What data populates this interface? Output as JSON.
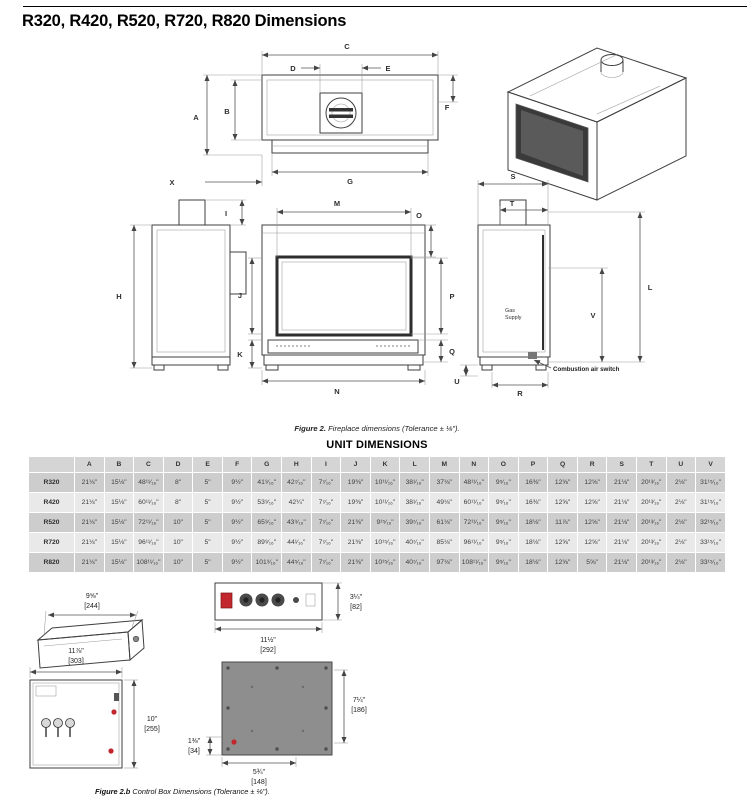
{
  "page": {
    "title": "R320, R420, R520, R720, R820 Dimensions"
  },
  "figure2": {
    "labels": {
      "A": "A",
      "B": "B",
      "C": "C",
      "D": "D",
      "E": "E",
      "F": "F",
      "G": "G",
      "H": "H",
      "I": "I",
      "J": "J",
      "K": "K",
      "L": "L",
      "M": "M",
      "N": "N",
      "O": "O",
      "P": "P",
      "Q": "Q",
      "R": "R",
      "S": "S",
      "T": "T",
      "U": "U",
      "V": "V",
      "X": "X"
    },
    "gas_supply_line1": "Gas",
    "gas_supply_line2": "Supply",
    "combustion_air_switch": "Combustion air switch",
    "caption_label": "Figure 2.",
    "caption_text": "  Fireplace dimensions (Tolerance ± ⅛\")."
  },
  "table": {
    "title": "UNIT DIMENSIONS",
    "columns": [
      "A",
      "B",
      "C",
      "D",
      "E",
      "F",
      "G",
      "H",
      "I",
      "J",
      "K",
      "L",
      "M",
      "N",
      "O",
      "P",
      "Q",
      "R",
      "S",
      "T",
      "U",
      "V"
    ],
    "rows": [
      {
        "model": "R320",
        "values": [
          "21⅛\"",
          "15⅛\"",
          "48¹¹⁄₁₆\"",
          "8\"",
          "5\"",
          "9½\"",
          "41⁹⁄₁₆\"",
          "42⁷⁄₁₆\"",
          "7⁷⁄₁₆\"",
          "19⅜\"",
          "10¹¹⁄₁₆\"",
          "38¹⁄₁₆\"",
          "37⅛\"",
          "48¹¹⁄₁₆\"",
          "9⁵⁄₁₆\"",
          "16⅜\"",
          "12⅝\"",
          "12⅝\"",
          "21⅛\"",
          "20¹³⁄₁₆\"",
          "2⅛\"",
          "31¹⁵⁄₁₆\""
        ]
      },
      {
        "model": "R420",
        "values": [
          "21⅛\"",
          "15⅛\"",
          "60¹¹⁄₁₆\"",
          "8\"",
          "5\"",
          "9½\"",
          "53⁹⁄₁₆\"",
          "42¼\"",
          "7⁷⁄₁₆\"",
          "19⅜\"",
          "10¹¹⁄₁₆\"",
          "38¹⁄₁₆\"",
          "49⅛\"",
          "60¹¹⁄₁₆\"",
          "9⁵⁄₁₆\"",
          "16⅜\"",
          "12⅝\"",
          "12⅝\"",
          "21⅛\"",
          "20¹³⁄₁₆\"",
          "2⅛\"",
          "31¹⁵⁄₁₆\""
        ]
      },
      {
        "model": "R520",
        "values": [
          "21⅛\"",
          "15⅛\"",
          "72¹¹⁄₁₆\"",
          "10\"",
          "5\"",
          "9½\"",
          "65⁹⁄₁₆\"",
          "43⁹⁄₁₆\"",
          "7⁷⁄₁₆\"",
          "21⅜\"",
          "9¹⁵⁄₁₆\"",
          "39⁷⁄₁₆\"",
          "61⅛\"",
          "72¹¹⁄₁₆\"",
          "9⁵⁄₁₆\"",
          "18⅛\"",
          "11⅞\"",
          "12⅝\"",
          "21⅛\"",
          "20¹³⁄₁₆\"",
          "2⅛\"",
          "32¹⁵⁄₁₆\""
        ]
      },
      {
        "model": "R720",
        "values": [
          "21⅛\"",
          "15⅛\"",
          "96¹¹⁄₁₆\"",
          "10\"",
          "5\"",
          "9½\"",
          "89⁹⁄₁₆\"",
          "44¹⁄₁₆\"",
          "7⁷⁄₁₆\"",
          "21⅜\"",
          "10¹⁵⁄₁₆\"",
          "40⁷⁄₁₆\"",
          "85⅛\"",
          "96¹¹⁄₁₆\"",
          "9⁵⁄₁₆\"",
          "18⅛\"",
          "12⅝\"",
          "12⅝\"",
          "21⅛\"",
          "20¹³⁄₁₆\"",
          "2⅛\"",
          "33¹⁵⁄₁₆\""
        ]
      },
      {
        "model": "R820",
        "values": [
          "21⅛\"",
          "15⅛\"",
          "108¹¹⁄₁₆\"",
          "10\"",
          "5\"",
          "9½\"",
          "101⁹⁄₁₆\"",
          "44⁵⁄₁₆\"",
          "7⁷⁄₁₆\"",
          "21⅜\"",
          "10¹⁵⁄₁₆\"",
          "40⁷⁄₁₆\"",
          "97⅛\"",
          "108¹¹⁄₁₆\"",
          "9⁵⁄₁₆\"",
          "18⅛\"",
          "12⅝\"",
          "5⅝\"",
          "21⅛\"",
          "20¹³⁄₁₆\"",
          "2⅛\"",
          "33¹⁵⁄₁₆\""
        ]
      }
    ]
  },
  "figure2b": {
    "dims": {
      "box_top_width": {
        "in": "9⅝\"",
        "mm": "[244]"
      },
      "box_top_depth": {
        "in": "3¼\"",
        "mm": "[82]"
      },
      "box_top_length": {
        "in": "11½\"",
        "mm": "[292]"
      },
      "box_front_width": {
        "in": "11⅞\"",
        "mm": "[303]"
      },
      "box_front_height": {
        "in": "10\"",
        "mm": "[255]"
      },
      "box_side_height": {
        "in": "7¼\"",
        "mm": "[186]"
      },
      "box_side_offset": {
        "in": "1⅜\"",
        "mm": "[34]"
      },
      "box_side_base": {
        "in": "5¾\"",
        "mm": "[148]"
      }
    },
    "caption_label": "Figure 2.b",
    "caption_text": "  Control Box Dimensions (Tolerance ± ⅛\")."
  },
  "colors": {
    "accent_red": "#c1272d",
    "line": "#3f3f3f",
    "table_row_dark": "#cdcdcd",
    "table_row_light": "#e9e9e9"
  }
}
